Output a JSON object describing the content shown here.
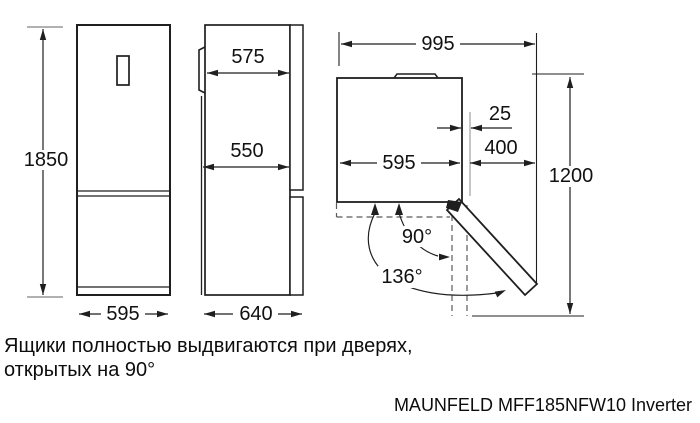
{
  "diagram_title_hint": "refrigerator dimension drawing",
  "colors": {
    "line": "#1f1f1f",
    "extension_line": "#979797",
    "dashed_line": "#5a5a5a",
    "background": "#ffffff"
  },
  "front_view": {
    "height_mm": "1850",
    "width_mm": "595"
  },
  "side_view": {
    "upper_depth_mm": "575",
    "lower_depth_mm": "550",
    "total_depth_mm": "640"
  },
  "top_view": {
    "total_width_open_mm": "995",
    "side_gap_mm": "25",
    "door_width_mm": "400",
    "body_width_mm": "595",
    "depth_door_open_mm": "1200",
    "door_angle_90": "90°",
    "door_angle_136": "136°"
  },
  "note": {
    "line1": "Ящики полностью выдвигаются при дверях,",
    "line2": "открытых на 90°"
  },
  "model": "MAUNFELD MFF185NFW10 Inverter"
}
